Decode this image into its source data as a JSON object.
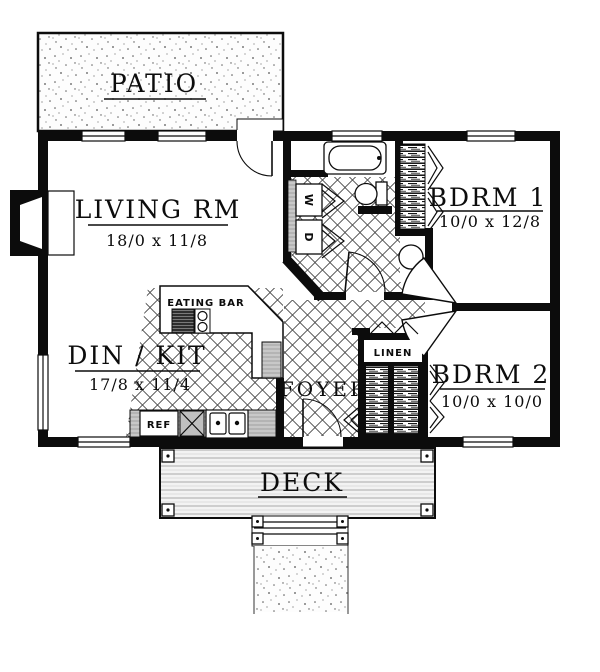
{
  "plan": {
    "title": "single-story-house-floor-plan",
    "rooms": {
      "patio": {
        "label": "PATIO"
      },
      "living": {
        "label": "LIVING RM",
        "dims": "18/0 x 11/8"
      },
      "dinkit": {
        "label": "DIN / KIT",
        "dims": "17/8 x 11/4"
      },
      "bdrm1": {
        "label": "BDRM 1",
        "dims": "10/0 x 12/8"
      },
      "bdrm2": {
        "label": "BDRM 2",
        "dims": "10/0 x 10/0"
      },
      "foyer": {
        "label": "FOYER"
      },
      "deck": {
        "label": "DECK"
      }
    },
    "features": {
      "eating_bar": "EATING BAR",
      "linen": "LINEN",
      "ref": "REF",
      "washer": "W",
      "dryer": "D"
    },
    "colors": {
      "wall": "#0c0c0c",
      "paper": "#ffffff",
      "counter_gray": "#cfcfcf",
      "tile_line": "#3a3a3a"
    }
  }
}
